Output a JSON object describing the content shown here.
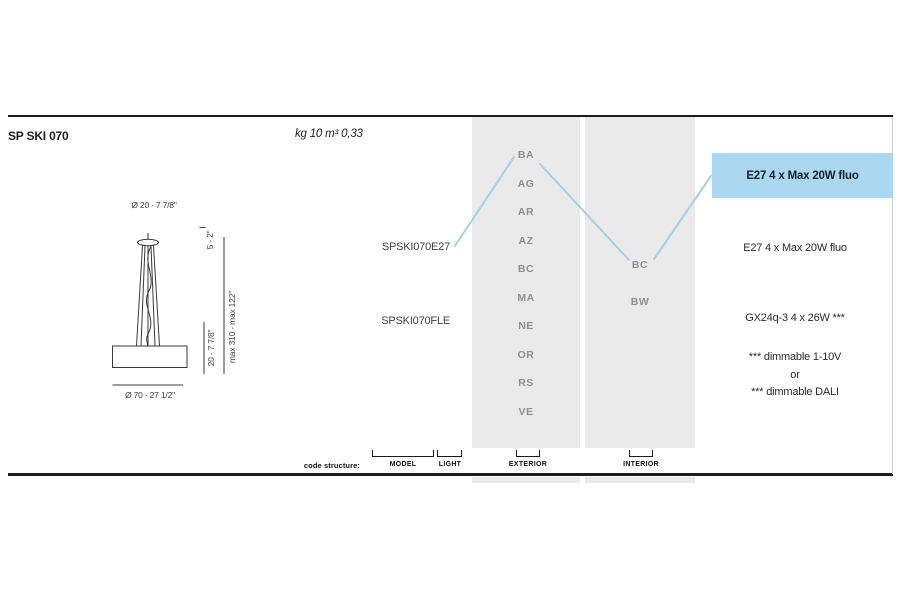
{
  "page": {
    "title": "SP SKI 070",
    "weight_volume": "kg 10 m³ 0,33"
  },
  "drawing": {
    "top_diameter": "Ø 20 - 7 7/8\"",
    "bottom_diameter": "Ø 70 - 27 1/2\"",
    "height_top": "5 - 2\"",
    "height_body": "20 - 7 7/8\"",
    "height_max": "max 310 - max 122\""
  },
  "models": {
    "e27": "SPSKI070E27",
    "fle": "SPSKI070FLE"
  },
  "exterior_codes": [
    "BA",
    "AG",
    "AR",
    "AZ",
    "BC",
    "MA",
    "NE",
    "OR",
    "RS",
    "VE"
  ],
  "interior_codes": [
    "BC",
    "BW"
  ],
  "lamping": {
    "highlight": "E27 4 x Max 20W fluo",
    "e27": "E27 4 x Max 20W fluo",
    "fluo": "GX24q-3 4 x 26W ***",
    "note1": "*** dimmable 1-10V",
    "note2": "or",
    "note3": "*** dimmable DALI"
  },
  "code_structure": {
    "label": "code structure:",
    "model": "MODEL",
    "light": "LIGHT",
    "exterior": "EXTERIOR",
    "interior": "INTERIOR"
  },
  "colors": {
    "highlight_blue": "#abd7f0",
    "connector_blue": "#a6cee6",
    "band_gray": "#eaeaea"
  }
}
